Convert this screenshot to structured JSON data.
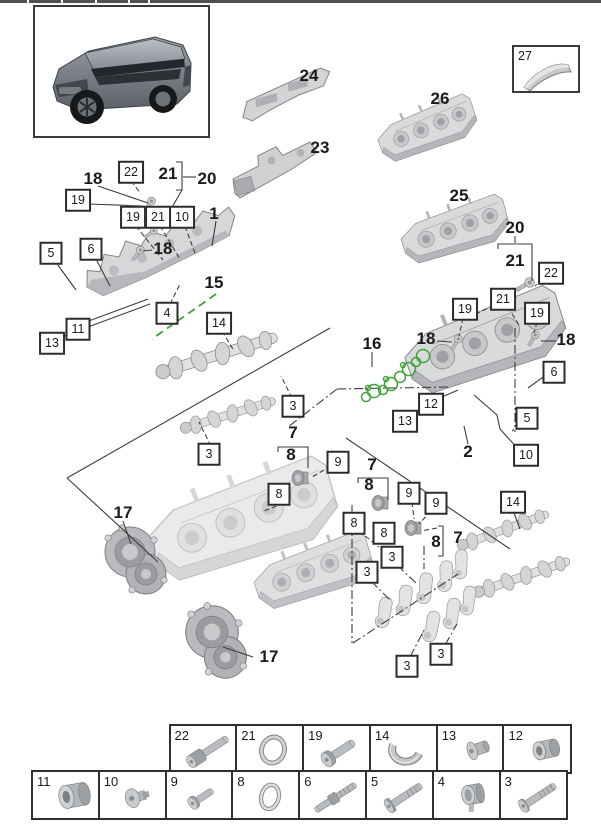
{
  "page": {
    "background": "#ffffff",
    "accent_green": "#3fa33a",
    "line_color": "#3c3c3c",
    "table_border": "#2f2f2f"
  },
  "diagram": {
    "inset_box": {
      "label": "27"
    },
    "callouts": [
      {
        "text": "19",
        "x": 78,
        "y": 200,
        "style": "boxed"
      },
      {
        "text": "22",
        "x": 131,
        "y": 172,
        "style": "boxed"
      },
      {
        "text": "19",
        "x": 133,
        "y": 217,
        "style": "boxed"
      },
      {
        "text": "21",
        "x": 158,
        "y": 217,
        "style": "boxed"
      },
      {
        "text": "10",
        "x": 182,
        "y": 217,
        "style": "boxed"
      },
      {
        "text": "5",
        "x": 51,
        "y": 253,
        "style": "boxed"
      },
      {
        "text": "6",
        "x": 91,
        "y": 249,
        "style": "boxed"
      },
      {
        "text": "11",
        "x": 78,
        "y": 329,
        "style": "boxed"
      },
      {
        "text": "13",
        "x": 52,
        "y": 343,
        "style": "boxed"
      },
      {
        "text": "4",
        "x": 167,
        "y": 313,
        "style": "boxed"
      },
      {
        "text": "14",
        "x": 219,
        "y": 323,
        "style": "boxed"
      },
      {
        "text": "3",
        "x": 293,
        "y": 406,
        "style": "boxed"
      },
      {
        "text": "3",
        "x": 209,
        "y": 454,
        "style": "boxed"
      },
      {
        "text": "9",
        "x": 338,
        "y": 462,
        "style": "boxed"
      },
      {
        "text": "8",
        "x": 279,
        "y": 494,
        "style": "boxed"
      },
      {
        "text": "8",
        "x": 354,
        "y": 523,
        "style": "boxed"
      },
      {
        "text": "8",
        "x": 384,
        "y": 533,
        "style": "boxed"
      },
      {
        "text": "9",
        "x": 409,
        "y": 493,
        "style": "boxed"
      },
      {
        "text": "9",
        "x": 436,
        "y": 503,
        "style": "boxed"
      },
      {
        "text": "3",
        "x": 392,
        "y": 557,
        "style": "boxed"
      },
      {
        "text": "3",
        "x": 367,
        "y": 572,
        "style": "boxed"
      },
      {
        "text": "3",
        "x": 407,
        "y": 666,
        "style": "boxed"
      },
      {
        "text": "3",
        "x": 441,
        "y": 654,
        "style": "boxed"
      },
      {
        "text": "14",
        "x": 513,
        "y": 502,
        "style": "boxed"
      },
      {
        "text": "22",
        "x": 551,
        "y": 273,
        "style": "boxed"
      },
      {
        "text": "21",
        "x": 503,
        "y": 299,
        "style": "boxed"
      },
      {
        "text": "19",
        "x": 465,
        "y": 309,
        "style": "boxed"
      },
      {
        "text": "19",
        "x": 537,
        "y": 313,
        "style": "boxed"
      },
      {
        "text": "6",
        "x": 554,
        "y": 372,
        "style": "boxed"
      },
      {
        "text": "12",
        "x": 431,
        "y": 404,
        "style": "boxed"
      },
      {
        "text": "13",
        "x": 405,
        "y": 421,
        "style": "boxed"
      },
      {
        "text": "5",
        "x": 527,
        "y": 418,
        "style": "boxed"
      },
      {
        "text": "10",
        "x": 526,
        "y": 455,
        "style": "boxed"
      },
      {
        "text": "18",
        "x": 93,
        "y": 179,
        "style": "bold"
      },
      {
        "text": "21",
        "x": 168,
        "y": 174,
        "style": "bold"
      },
      {
        "text": "20",
        "x": 207,
        "y": 179,
        "style": "bold"
      },
      {
        "text": "1",
        "x": 214,
        "y": 214,
        "style": "bold"
      },
      {
        "text": "18",
        "x": 163,
        "y": 249,
        "style": "bold"
      },
      {
        "text": "15",
        "x": 214,
        "y": 283,
        "style": "bold"
      },
      {
        "text": "24",
        "x": 309,
        "y": 76,
        "style": "bold"
      },
      {
        "text": "23",
        "x": 320,
        "y": 148,
        "style": "bold"
      },
      {
        "text": "26",
        "x": 440,
        "y": 99,
        "style": "bold"
      },
      {
        "text": "25",
        "x": 459,
        "y": 196,
        "style": "bold"
      },
      {
        "text": "20",
        "x": 515,
        "y": 228,
        "style": "bold"
      },
      {
        "text": "21",
        "x": 515,
        "y": 261,
        "style": "bold"
      },
      {
        "text": "16",
        "x": 372,
        "y": 344,
        "style": "bold"
      },
      {
        "text": "18",
        "x": 426,
        "y": 339,
        "style": "bold"
      },
      {
        "text": "18",
        "x": 566,
        "y": 340,
        "style": "bold"
      },
      {
        "text": "2",
        "x": 468,
        "y": 452,
        "style": "bold"
      },
      {
        "text": "17",
        "x": 123,
        "y": 513,
        "style": "bold"
      },
      {
        "text": "17",
        "x": 269,
        "y": 657,
        "style": "bold"
      },
      {
        "text": "7",
        "x": 293,
        "y": 433,
        "style": "bold"
      },
      {
        "text": "8",
        "x": 291,
        "y": 455,
        "style": "bold"
      },
      {
        "text": "7",
        "x": 372,
        "y": 465,
        "style": "bold"
      },
      {
        "text": "8",
        "x": 369,
        "y": 485,
        "style": "bold"
      },
      {
        "text": "8",
        "x": 436,
        "y": 542,
        "style": "bold"
      },
      {
        "text": "7",
        "x": 458,
        "y": 538,
        "style": "bold"
      }
    ]
  },
  "parts_table": {
    "rows": [
      {
        "cells": [
          {
            "number": "22"
          },
          {
            "number": "21"
          },
          {
            "number": "19"
          },
          {
            "number": "14"
          },
          {
            "number": "13"
          },
          {
            "number": "12"
          }
        ]
      },
      {
        "cells": [
          {
            "number": "11"
          },
          {
            "number": "10"
          },
          {
            "number": "9"
          },
          {
            "number": "8"
          },
          {
            "number": "6"
          },
          {
            "number": "5"
          },
          {
            "number": "4"
          },
          {
            "number": "3"
          }
        ]
      }
    ]
  }
}
